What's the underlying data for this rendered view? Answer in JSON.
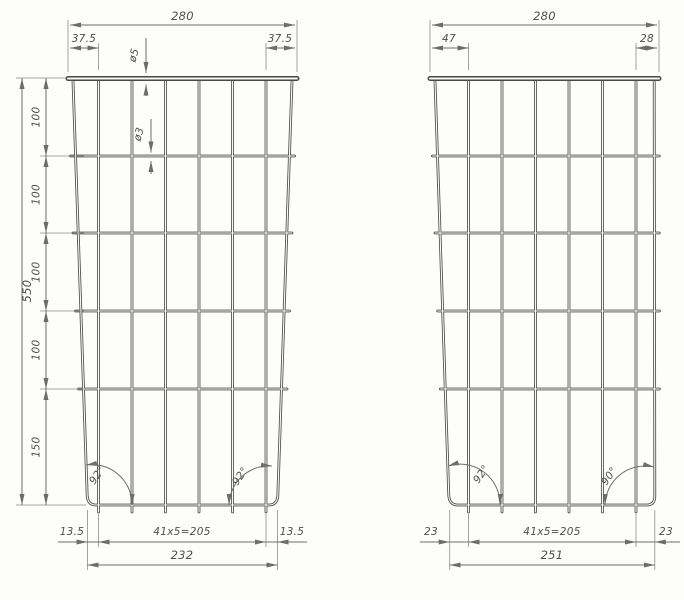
{
  "drawing": {
    "left_panel": {
      "top_width": "280",
      "top_left_offset": "37.5",
      "top_right_offset": "37.5",
      "bar_diameter": "ø5",
      "wire_diameter": "ø3",
      "height_segments": [
        "100",
        "100",
        "100",
        "100",
        "150"
      ],
      "total_height": "550",
      "bottom_left_offset": "13.5",
      "bottom_pitch": "41x5=205",
      "bottom_right_offset": "13.5",
      "bottom_width": "232",
      "bottom_left_angle": "92°",
      "bottom_right_angle": "92°"
    },
    "right_panel": {
      "top_width": "280",
      "top_left_offset": "47",
      "top_right_offset": "28",
      "bottom_left_offset": "23",
      "bottom_pitch": "41x5=205",
      "bottom_right_offset": "23",
      "bottom_width": "251",
      "bottom_left_angle": "92°",
      "bottom_right_angle": "90°"
    },
    "colors": {
      "wire": "#4d4d4d",
      "dimension": "#6d6d6d",
      "background": "#fdfdfc"
    }
  }
}
